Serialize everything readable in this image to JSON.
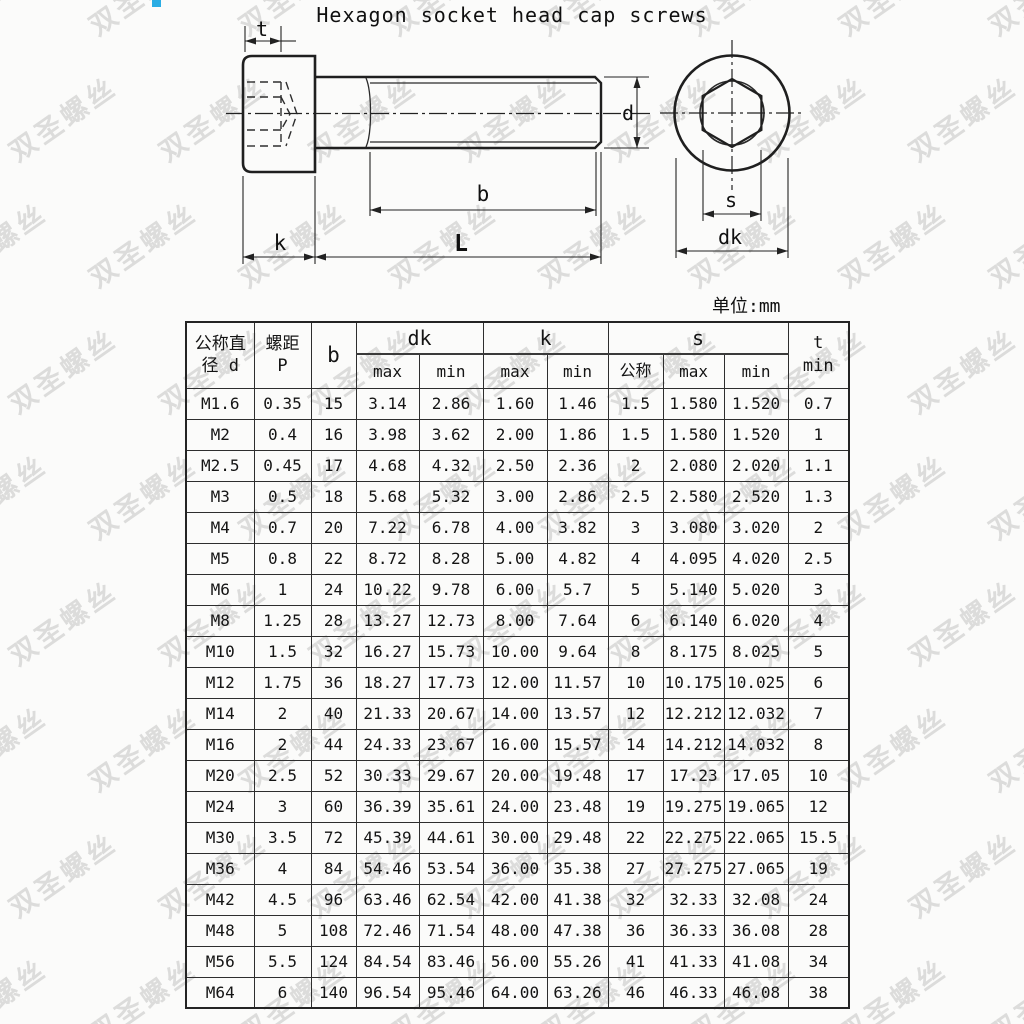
{
  "title": "Hexagon socket head cap screws",
  "unit_label": "单位:mm",
  "watermark_text": "双圣螺丝",
  "colors": {
    "accent_blue": "#2aade4",
    "line_dark": "#1f1f1f"
  },
  "drawing": {
    "labels": {
      "t": "t",
      "k": "k",
      "L": "L",
      "b": "b",
      "d": "d",
      "s": "s",
      "dk": "dk"
    }
  },
  "table": {
    "header": {
      "col_diameter": "公称直\n径 d",
      "col_pitch": "螺距\nP",
      "col_b": "b",
      "group_dk": "dk",
      "group_k": "k",
      "group_s": "s",
      "col_t": "t\nmin",
      "sub_row": [
        "max",
        "min",
        "max",
        "min",
        "公称",
        "max",
        "min"
      ]
    },
    "rows": [
      [
        "M1.6",
        "0.35",
        "15",
        "3.14",
        "2.86",
        "1.60",
        "1.46",
        "1.5",
        "1.580",
        "1.520",
        "0.7"
      ],
      [
        "M2",
        "0.4",
        "16",
        "3.98",
        "3.62",
        "2.00",
        "1.86",
        "1.5",
        "1.580",
        "1.520",
        "1"
      ],
      [
        "M2.5",
        "0.45",
        "17",
        "4.68",
        "4.32",
        "2.50",
        "2.36",
        "2",
        "2.080",
        "2.020",
        "1.1"
      ],
      [
        "M3",
        "0.5",
        "18",
        "5.68",
        "5.32",
        "3.00",
        "2.86",
        "2.5",
        "2.580",
        "2.520",
        "1.3"
      ],
      [
        "M4",
        "0.7",
        "20",
        "7.22",
        "6.78",
        "4.00",
        "3.82",
        "3",
        "3.080",
        "3.020",
        "2"
      ],
      [
        "M5",
        "0.8",
        "22",
        "8.72",
        "8.28",
        "5.00",
        "4.82",
        "4",
        "4.095",
        "4.020",
        "2.5"
      ],
      [
        "M6",
        "1",
        "24",
        "10.22",
        "9.78",
        "6.00",
        "5.7",
        "5",
        "5.140",
        "5.020",
        "3"
      ],
      [
        "M8",
        "1.25",
        "28",
        "13.27",
        "12.73",
        "8.00",
        "7.64",
        "6",
        "6.140",
        "6.020",
        "4"
      ],
      [
        "M10",
        "1.5",
        "32",
        "16.27",
        "15.73",
        "10.00",
        "9.64",
        "8",
        "8.175",
        "8.025",
        "5"
      ],
      [
        "M12",
        "1.75",
        "36",
        "18.27",
        "17.73",
        "12.00",
        "11.57",
        "10",
        "10.175",
        "10.025",
        "6"
      ],
      [
        "M14",
        "2",
        "40",
        "21.33",
        "20.67",
        "14.00",
        "13.57",
        "12",
        "12.212",
        "12.032",
        "7"
      ],
      [
        "M16",
        "2",
        "44",
        "24.33",
        "23.67",
        "16.00",
        "15.57",
        "14",
        "14.212",
        "14.032",
        "8"
      ],
      [
        "M20",
        "2.5",
        "52",
        "30.33",
        "29.67",
        "20.00",
        "19.48",
        "17",
        "17.23",
        "17.05",
        "10"
      ],
      [
        "M24",
        "3",
        "60",
        "36.39",
        "35.61",
        "24.00",
        "23.48",
        "19",
        "19.275",
        "19.065",
        "12"
      ],
      [
        "M30",
        "3.5",
        "72",
        "45.39",
        "44.61",
        "30.00",
        "29.48",
        "22",
        "22.275",
        "22.065",
        "15.5"
      ],
      [
        "M36",
        "4",
        "84",
        "54.46",
        "53.54",
        "36.00",
        "35.38",
        "27",
        "27.275",
        "27.065",
        "19"
      ],
      [
        "M42",
        "4.5",
        "96",
        "63.46",
        "62.54",
        "42.00",
        "41.38",
        "32",
        "32.33",
        "32.08",
        "24"
      ],
      [
        "M48",
        "5",
        "108",
        "72.46",
        "71.54",
        "48.00",
        "47.38",
        "36",
        "36.33",
        "36.08",
        "28"
      ],
      [
        "M56",
        "5.5",
        "124",
        "84.54",
        "83.46",
        "56.00",
        "55.26",
        "41",
        "41.33",
        "41.08",
        "34"
      ],
      [
        "M64",
        "6",
        "140",
        "96.54",
        "95.46",
        "64.00",
        "63.26",
        "46",
        "46.33",
        "46.08",
        "38"
      ]
    ]
  }
}
